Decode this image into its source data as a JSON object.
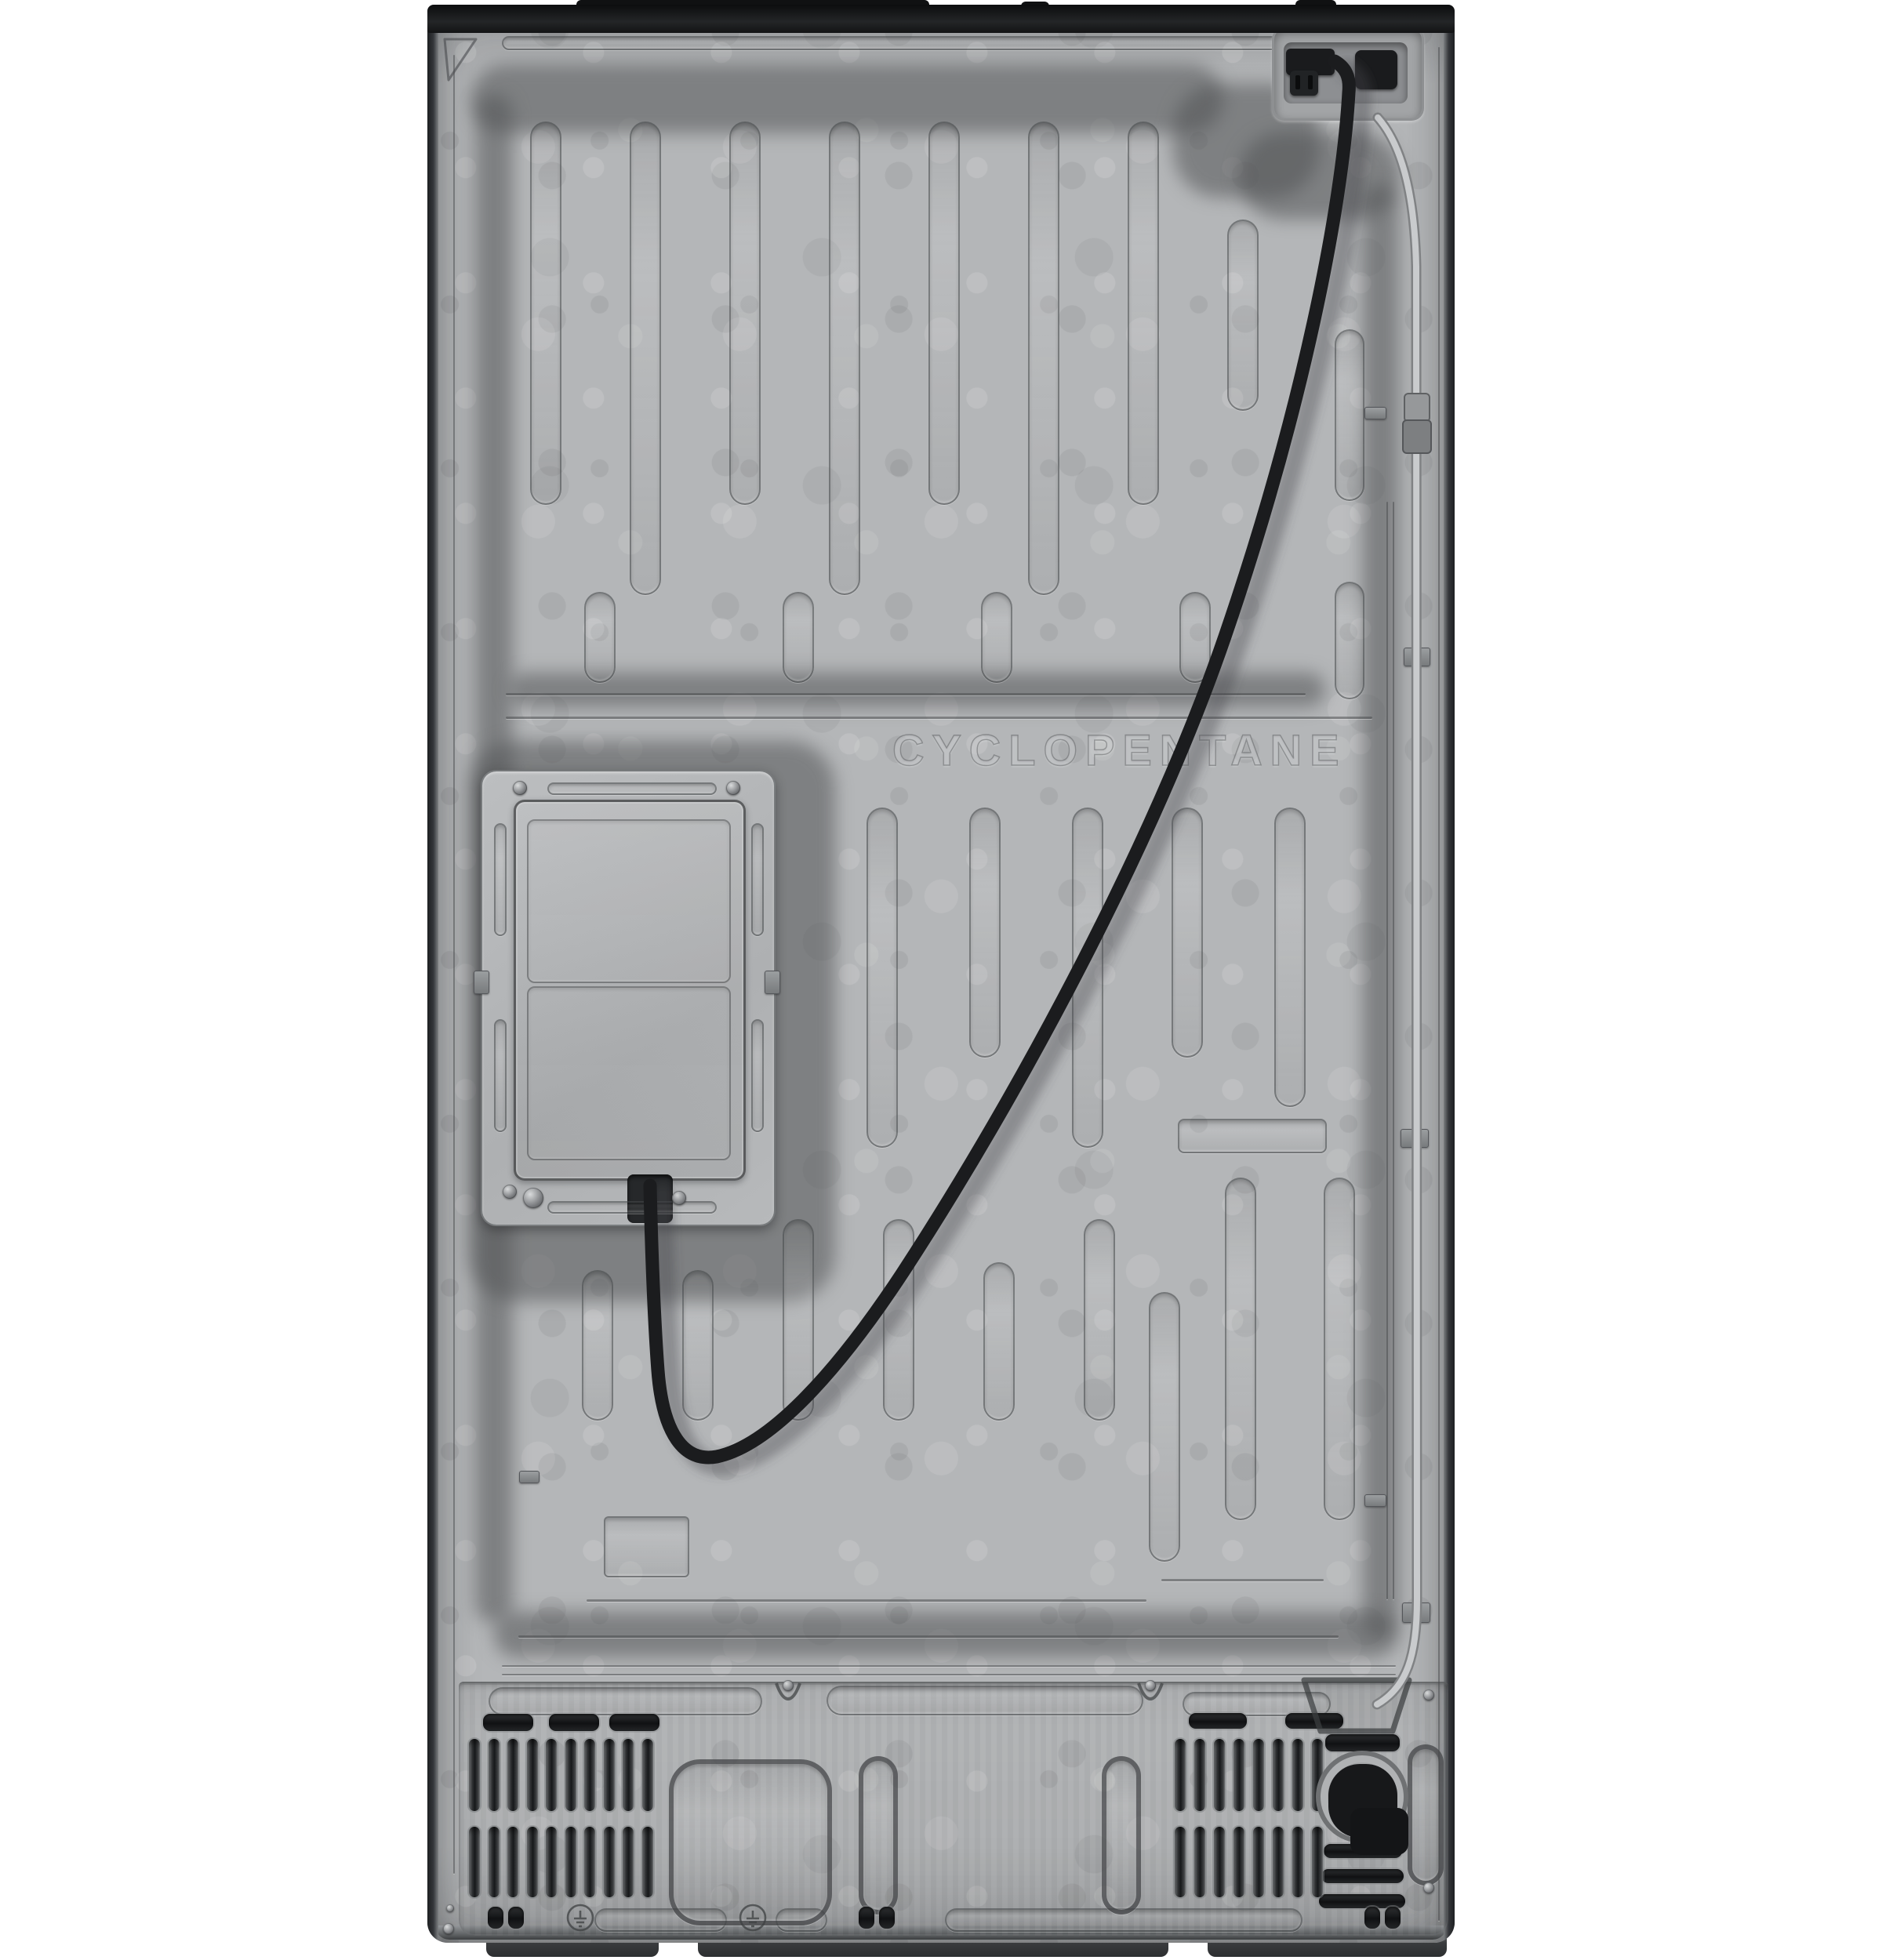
{
  "panel": {
    "embossed_text": "CYCLOPENTANE"
  },
  "colors": {
    "background": "#ffffff",
    "panel_base": "#b4b6b8",
    "panel_light": "#c9cbcd",
    "panel_dark": "#9a9c9e",
    "channel_shadow": "#525456",
    "edge_dark": "#1e2022",
    "top_cap": "#101112",
    "power_cord": "#1b1c1e",
    "water_line": "#c9cbcd",
    "vent_slot_dark": "#17191b",
    "foot": "#3a3c3e"
  }
}
